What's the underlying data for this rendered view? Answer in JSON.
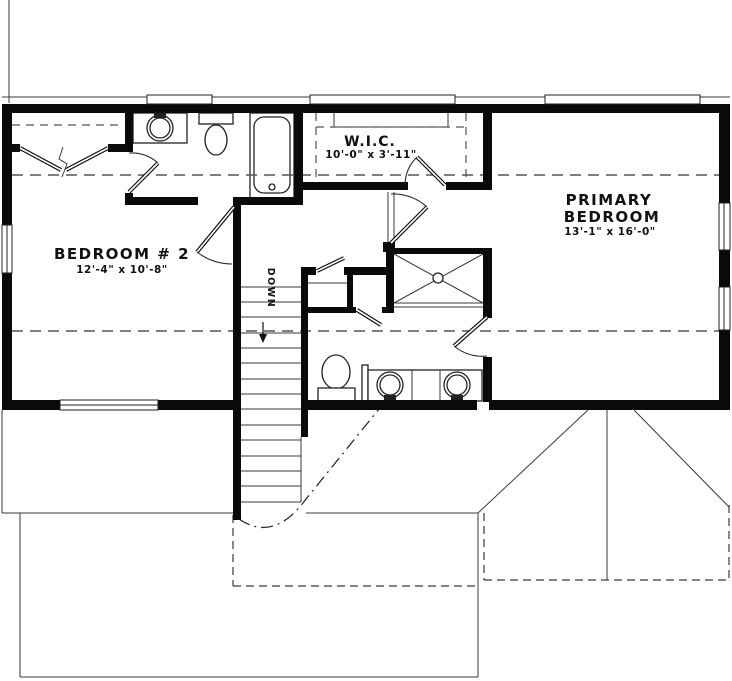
{
  "plan": {
    "rooms": {
      "bedroom2": {
        "name": "BEDROOM # 2",
        "dims": "12'-4\" x 10'-8\""
      },
      "wic": {
        "name": "W.I.C.",
        "dims": "10'-0\" x 3'-11\""
      },
      "primary_bedroom": {
        "name_line1": "PRIMARY",
        "name_line2": "BEDROOM",
        "dims": "13'-1\" x 16'-0\""
      }
    },
    "stairs": {
      "label": "DOWN"
    }
  },
  "colors": {
    "background": "#ffffff",
    "walls": "#0a0a0a",
    "thin_lines": "#3a3a3a",
    "dashed_lines": "#555555",
    "text": "#111111"
  }
}
